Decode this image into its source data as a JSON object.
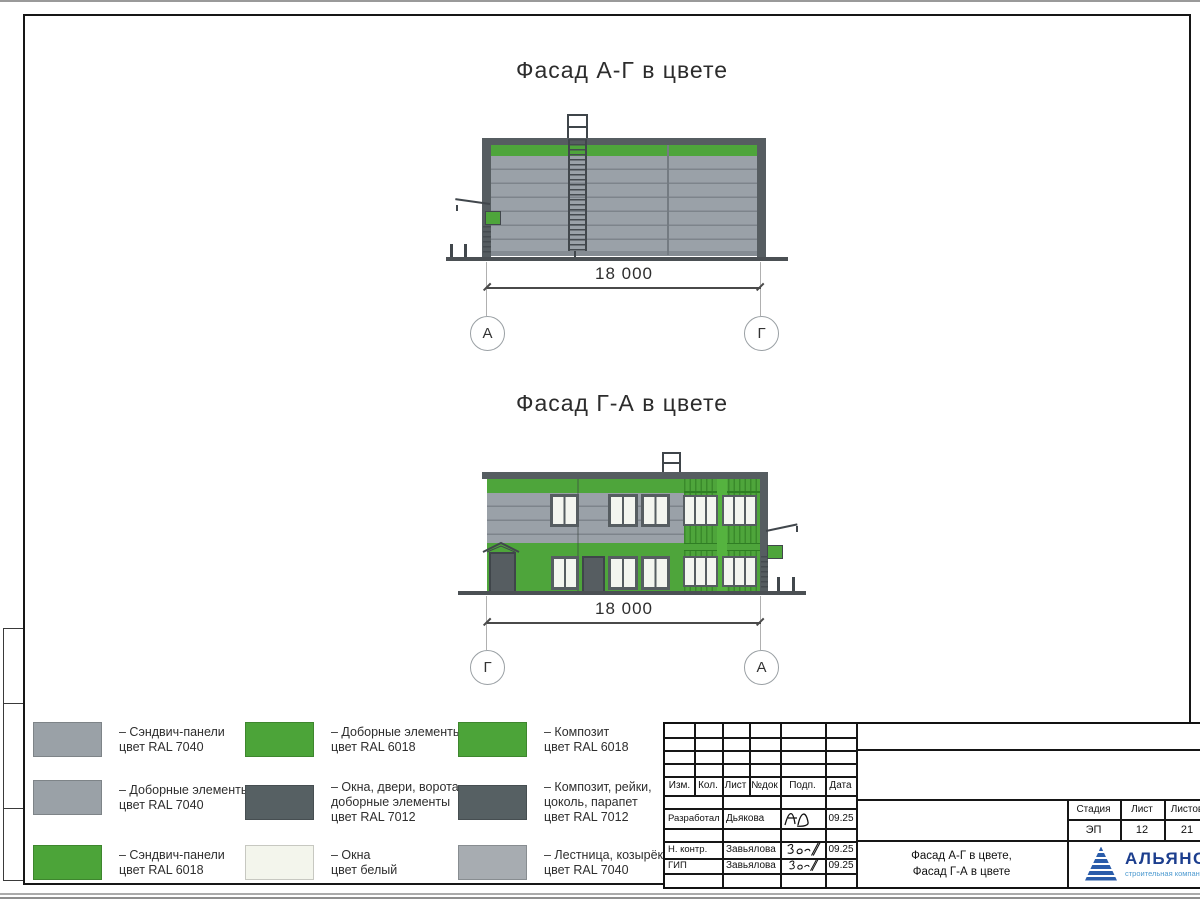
{
  "drawings": {
    "facade_ag": {
      "title": "Фасад А-Г в цвете",
      "dimension": "18 000",
      "axes": [
        "А",
        "Г"
      ]
    },
    "facade_ga": {
      "title": "Фасад Г-А в цвете",
      "dimension": "18 000",
      "axes": [
        "Г",
        "А"
      ]
    }
  },
  "legend": {
    "columns": [
      {
        "items": [
          {
            "color": "#9aa1a7",
            "lines": [
              "– Сэндвич-панели",
              "цвет RAL 7040"
            ]
          },
          {
            "color": "#9aa1a7",
            "lines": [
              "– Доборные элементы",
              "цвет RAL 7040"
            ]
          },
          {
            "color": "#4ca439",
            "lines": [
              "– Сэндвич-панели",
              "цвет RAL 6018"
            ]
          }
        ]
      },
      {
        "items": [
          {
            "color": "#4ca439",
            "lines": [
              "– Доборные элементы",
              "цвет RAL 6018"
            ]
          },
          {
            "color": "#566063",
            "lines": [
              "– Окна, двери, ворота,",
              "доборные элементы",
              "цвет RAL 7012"
            ]
          },
          {
            "color": "#f3f5ec",
            "lines": [
              "– Окна",
              "цвет белый"
            ]
          }
        ]
      },
      {
        "items": [
          {
            "color": "#4ca439",
            "lines": [
              "– Композит",
              "цвет RAL 6018"
            ]
          },
          {
            "color": "#566063",
            "lines": [
              "– Композит, рейки,",
              "цоколь, парапет",
              "цвет RAL 7012"
            ]
          },
          {
            "color": "#a7acb1",
            "lines": [
              "– Лестница, козырёк",
              "цвет RAL 7040"
            ]
          }
        ]
      }
    ]
  },
  "title_block": {
    "revision_headers": [
      "Изм.",
      "Кол.",
      "Лист",
      "№док",
      "Подп.",
      "Дата"
    ],
    "signature_rows": [
      {
        "role": "Разработал",
        "name": "Дьякова",
        "date": "09.25"
      },
      {
        "role": "Н. контр.",
        "name": "Завьялова",
        "date": "09.25"
      },
      {
        "role": "ГИП",
        "name": "Завьялова",
        "date": "09.25"
      }
    ],
    "stage": {
      "headers": [
        "Стадия",
        "Лист",
        "Листов"
      ],
      "values": [
        "ЭП",
        "12",
        "21"
      ]
    },
    "sheet_title": [
      "Фасад А-Г в цвете,",
      "Фасад Г-А в цвете"
    ],
    "logo": {
      "name": "АЛЬЯНС",
      "subtitle": "строительная компания"
    }
  },
  "palette": {
    "sandwich_gray_ral7040": "#9aa1a7",
    "green_ral6018": "#4ea53b",
    "dark_ral7012": "#565d61",
    "window_white": "#f3f5ef",
    "logo_blue": "#1c3e8e",
    "logo_light_blue": "#4d9ad0"
  }
}
